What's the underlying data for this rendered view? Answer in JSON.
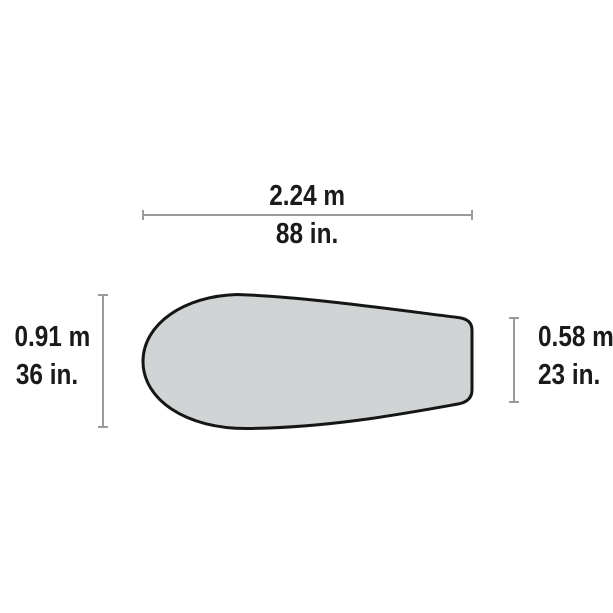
{
  "diagram": {
    "subject": "tent footprint top view with dimensions",
    "shape": {
      "name": "footprint-teardrop-shape",
      "fill": "#d0d4d4",
      "outline": "#161616"
    },
    "dimension_line_color": "#9b9b9b",
    "text_color": "#1a1a1a",
    "background": "#ffffff"
  },
  "dimensions": {
    "width": {
      "metric": "2.24 m",
      "imperial": "88 in."
    },
    "head_height": {
      "metric": "0.91 m",
      "imperial": "36 in."
    },
    "foot_height": {
      "metric": "0.58 m",
      "imperial": "23 in."
    }
  }
}
